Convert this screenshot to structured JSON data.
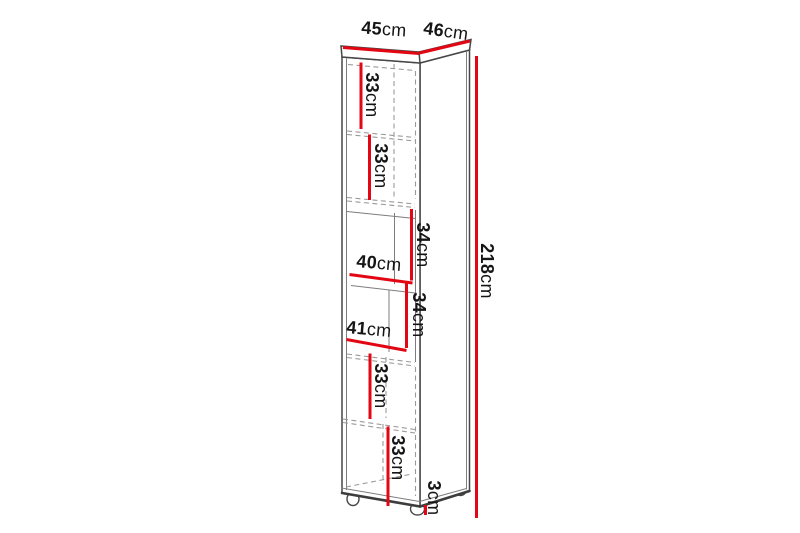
{
  "canvas": {
    "background": "#ffffff",
    "width": 800,
    "height": 533
  },
  "diagram": {
    "type": "furniture-dimension-drawing",
    "subject": "tall narrow shelf cabinet with feet",
    "accent_color": "#e30613",
    "line_color": "#474747",
    "text_color": "#151515"
  },
  "dimensions": {
    "front_width": {
      "value": "45",
      "unit": "cm"
    },
    "side_depth": {
      "value": "46",
      "unit": "cm"
    },
    "total_height": {
      "value": "218",
      "unit": "cm"
    },
    "compartment_1": {
      "value": "33",
      "unit": "cm"
    },
    "compartment_2": {
      "value": "33",
      "unit": "cm"
    },
    "niche_1_height": {
      "value": "34",
      "unit": "cm"
    },
    "niche_1_width": {
      "value": "40",
      "unit": "cm"
    },
    "niche_2_height": {
      "value": "34",
      "unit": "cm"
    },
    "niche_2_width": {
      "value": "41",
      "unit": "cm"
    },
    "compartment_3": {
      "value": "33",
      "unit": "cm"
    },
    "compartment_4": {
      "value": "33",
      "unit": "cm"
    },
    "feet_height": {
      "value": "3",
      "unit": "cm"
    }
  }
}
